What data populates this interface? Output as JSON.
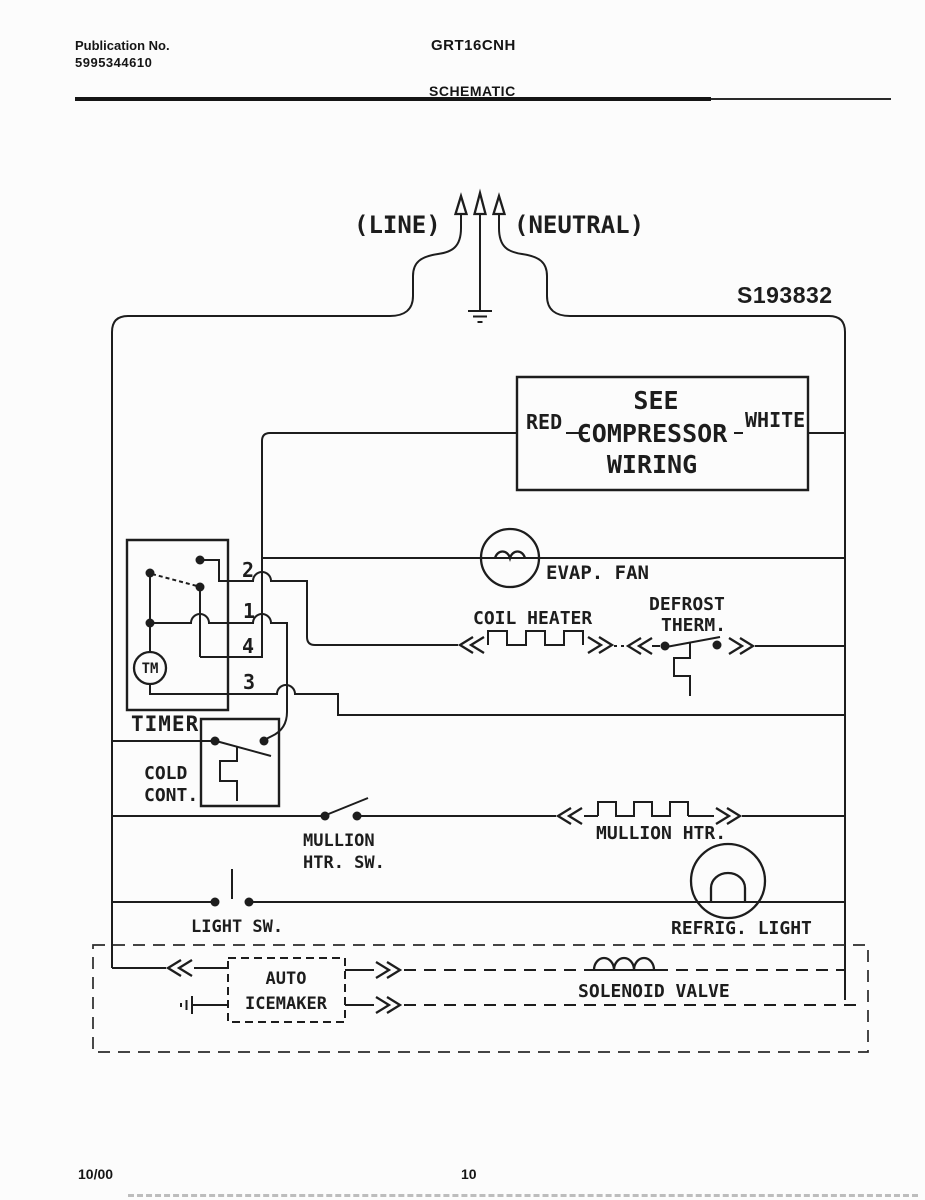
{
  "header": {
    "publication_label": "Publication No.",
    "publication_number": "5995344610",
    "model": "GRT16CNH",
    "title": "SCHEMATIC"
  },
  "supply": {
    "line": "(LINE)",
    "neutral": "(NEUTRAL)"
  },
  "part_number": "S193832",
  "compressor": {
    "line1": "SEE",
    "line2": "COMPRESSOR",
    "line3": "WIRING",
    "left_wire": "RED",
    "right_wire": "WHITE"
  },
  "components": {
    "evap_fan": "EVAP. FAN",
    "coil_heater": "COIL HEATER",
    "defrost_therm_line1": "DEFROST",
    "defrost_therm_line2": "THERM.",
    "timer_label": "TIMER",
    "timer_motor": "TM",
    "timer_terminals": {
      "t2": "2",
      "t1": "1",
      "t4": "4",
      "t3": "3"
    },
    "cold_control_line1": "COLD",
    "cold_control_line2": "CONT.",
    "mullion_switch_line1": "MULLION",
    "mullion_switch_line2": "HTR. SW.",
    "mullion_heater": "MULLION HTR.",
    "light_switch": "LIGHT SW.",
    "refrig_light": "REFRIG. LIGHT",
    "icemaker_line1": "AUTO",
    "icemaker_line2": "ICEMAKER",
    "solenoid_valve": "SOLENOID VALVE"
  },
  "footer": {
    "date": "10/00",
    "page": "10"
  },
  "colors": {
    "ink": "#1d1d1d",
    "paper": "#fcfcfc"
  }
}
